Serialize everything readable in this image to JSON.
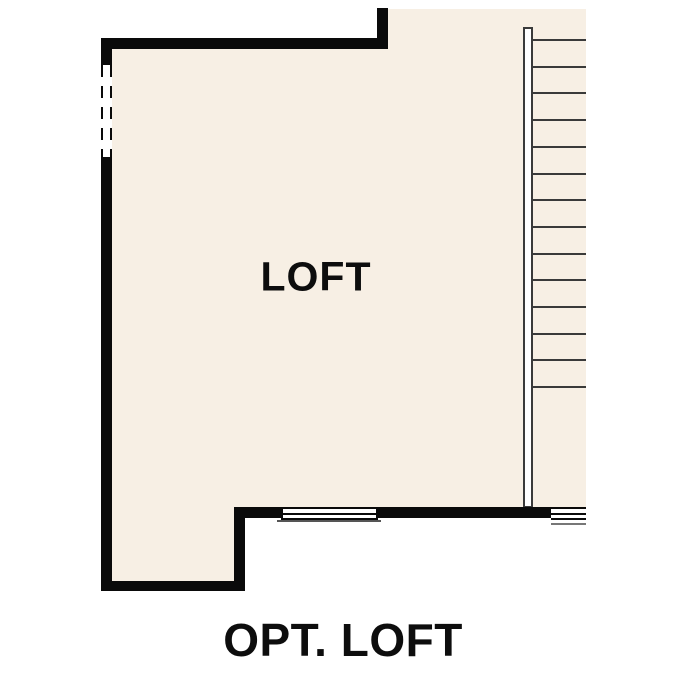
{
  "plan": {
    "room_label": "LOFT",
    "caption": "OPT. LOFT"
  },
  "colors": {
    "background": "#ffffff",
    "floor": "#f7efe4",
    "wall": "#0a0a0a",
    "stair_line": "#3a3a3a",
    "window_sill": "#777777",
    "text": "#0d0d0d"
  },
  "stairs": {
    "tread_count": 14,
    "first_tread_y": 39,
    "tread_spacing": 26.7,
    "tread_x": 533,
    "tread_length": 53
  }
}
